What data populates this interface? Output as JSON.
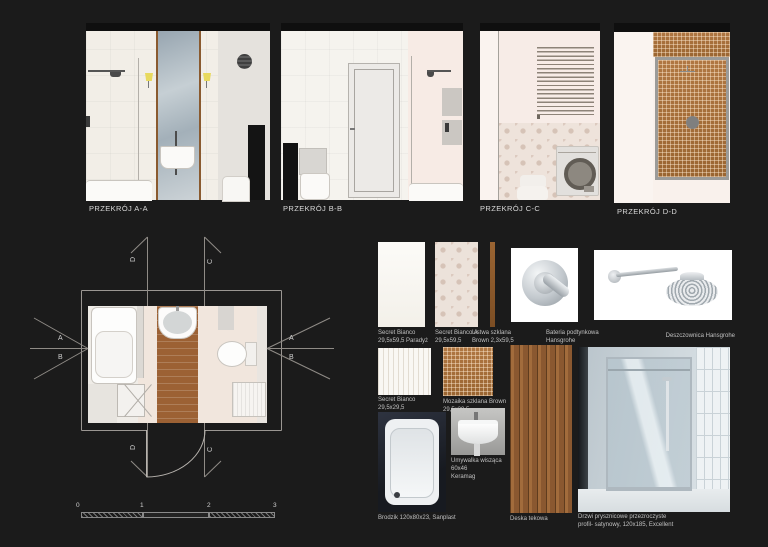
{
  "section_views": [
    {
      "label": "PRZEKRÓJ A-A"
    },
    {
      "label": "PRZEKRÓJ B-B"
    },
    {
      "label": "PRZEKRÓJ C-C"
    },
    {
      "label": "PRZEKRÓJ D-D"
    }
  ],
  "plan": {
    "mark_a": "A",
    "mark_b": "B",
    "mark_c": "C",
    "mark_d": "D",
    "scale_ticks": [
      "0",
      "1",
      "2",
      "3"
    ]
  },
  "samples": [
    {
      "name": "Secret Bianco",
      "detail": "29,5x59,5 Paradyż"
    },
    {
      "name": "Secret Bianco A",
      "detail": "29,5x59,5"
    },
    {
      "name": "Listwa szklana",
      "detail": "Brown 2,3x59,5"
    },
    {
      "name": "Bateria podtynkowa",
      "detail": "Hansgrohe"
    },
    {
      "name": "Deszczownica Hansgrohe",
      "detail": ""
    },
    {
      "name": "Secret Bianco",
      "detail": "29,5x29,5"
    },
    {
      "name": "Mozaika szklana Brown",
      "detail": "29,5x29,5"
    },
    {
      "name": "Umywalka wisząca 60x46",
      "detail": "Keramag"
    },
    {
      "name": "Brodzik 120x80x23, Sanplast",
      "detail": ""
    },
    {
      "name": "Deska tekowa",
      "detail": ""
    },
    {
      "name": "Drzwi prysznicowe przezroczyste",
      "detail": "profil- satynowy, 120x185, Excellent"
    }
  ],
  "colors": {
    "background": "#1b1b1b",
    "wall_cream": "#f2eee7",
    "wall_pink": "#f7ebe5",
    "wood_floor": "#9c6134",
    "mosaic_brown": "#a8713c",
    "mirror_blue": "#a9b4bc",
    "sconce_yellow": "#e8d95e",
    "label_text": "#c0c0c0"
  }
}
